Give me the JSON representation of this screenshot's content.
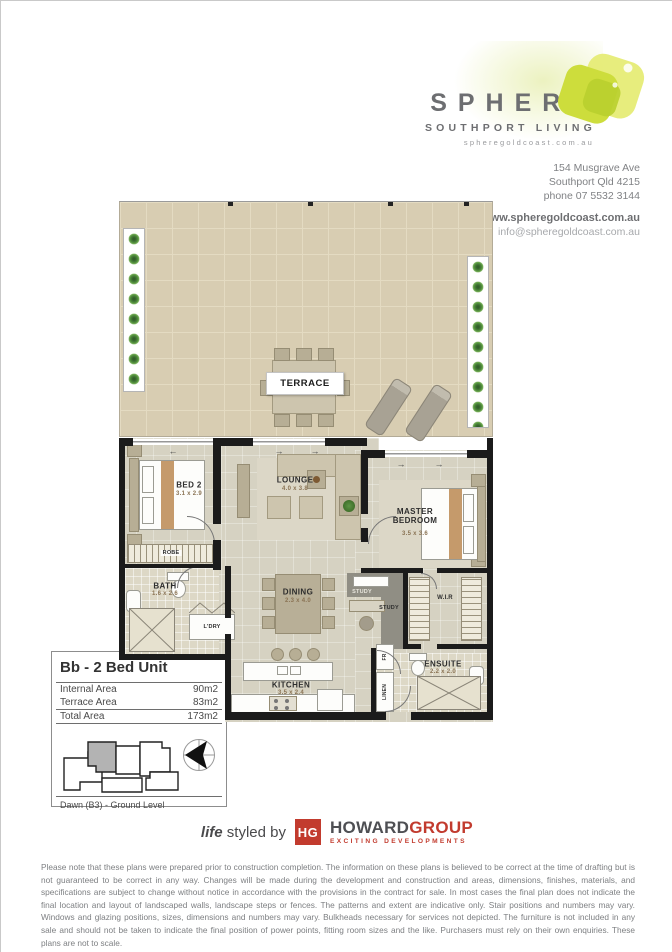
{
  "header": {
    "brand": "SPHERE",
    "tagline": "SOUTHPORT LIVING",
    "brand_site": "spheregoldcoast.com.au",
    "address1": "154 Musgrave Ave",
    "address2": "Southport Qld 4215",
    "phone": "phone 07 5532 3144",
    "website": "www.spheregoldcoast.com.au",
    "email": "info@spheregoldcoast.com.au"
  },
  "plan": {
    "arrows": {
      "left": "←",
      "right": "→"
    },
    "rooms": {
      "terrace": {
        "name": "TERRACE"
      },
      "bed2": {
        "name": "BED 2",
        "dims": "3.1 x 2.9"
      },
      "lounge": {
        "name": "LOUNGE",
        "dims": "4.0 x 3.8"
      },
      "master": {
        "name": "MASTER BEDROOM",
        "dims": "3.5 x 3.6"
      },
      "robe": {
        "name": "ROBE"
      },
      "bath": {
        "name": "BATH",
        "dims": "1.6 x 2.6"
      },
      "dining": {
        "name": "DINING",
        "dims": "2.3 x 4.0"
      },
      "laundry": {
        "name": "L'DRY"
      },
      "study_nook": {
        "name": "STUDY"
      },
      "study": {
        "name": "STUDY"
      },
      "wir": {
        "name": "W.I.R"
      },
      "kitchen": {
        "name": "KITCHEN",
        "dims": "3.5 x 2.4"
      },
      "fridge": {
        "name": "FR"
      },
      "linen": {
        "name": "LINEN"
      },
      "ensuite": {
        "name": "ENSUITE",
        "dims": "2.2 x 2.0"
      }
    }
  },
  "info_box": {
    "title": "Bb - 2 Bed Unit",
    "rows": [
      {
        "label": "Internal Area",
        "value": "90m2"
      },
      {
        "label": "Terrace Area",
        "value": "83m2"
      },
      {
        "label": "Total Area",
        "value": "173m2"
      }
    ],
    "level_caption": "Dawn (B3) - Ground Level"
  },
  "footer": {
    "life": "life",
    "styled_by": "styled by",
    "monogram": "HG",
    "howard": "HOWARD",
    "group": "GROUP",
    "subbrand": "EXCITING DEVELOPMENTS",
    "disclaimer": "Please note that these plans were prepared prior to construction completion. The information on these plans is believed to be correct at the time of drafting but is not guaranteed to be correct in any way. Changes will be made during the development and construction and areas, dimensions, finishes, materials, and specifications are subject to change without notice in accordance with the provisions in the contract for sale. In most cases the final plan does not indicate the final location and layout of landscaped walls, landscape steps or fences. The patterns and extent are indicative only. Stair positions and numbers may vary. Windows and glazing positions, sizes, dimensions and numbers may vary. Bulkheads necessary for services not depicted. The furniture is not included in any sale and should not be taken to indicate the final position of power points, fitting room sizes and the like. Purchasers must rely on their own enquiries. These plans are not to scale."
  },
  "colors": {
    "accent_green": "#cbdb2a",
    "brand_gray": "#6d6e71",
    "howard_red": "#c23b2e",
    "wall_black": "#1b1b1b",
    "terrace_tile": "#d8cdb2",
    "interior_floor": "#d6d2c2"
  }
}
